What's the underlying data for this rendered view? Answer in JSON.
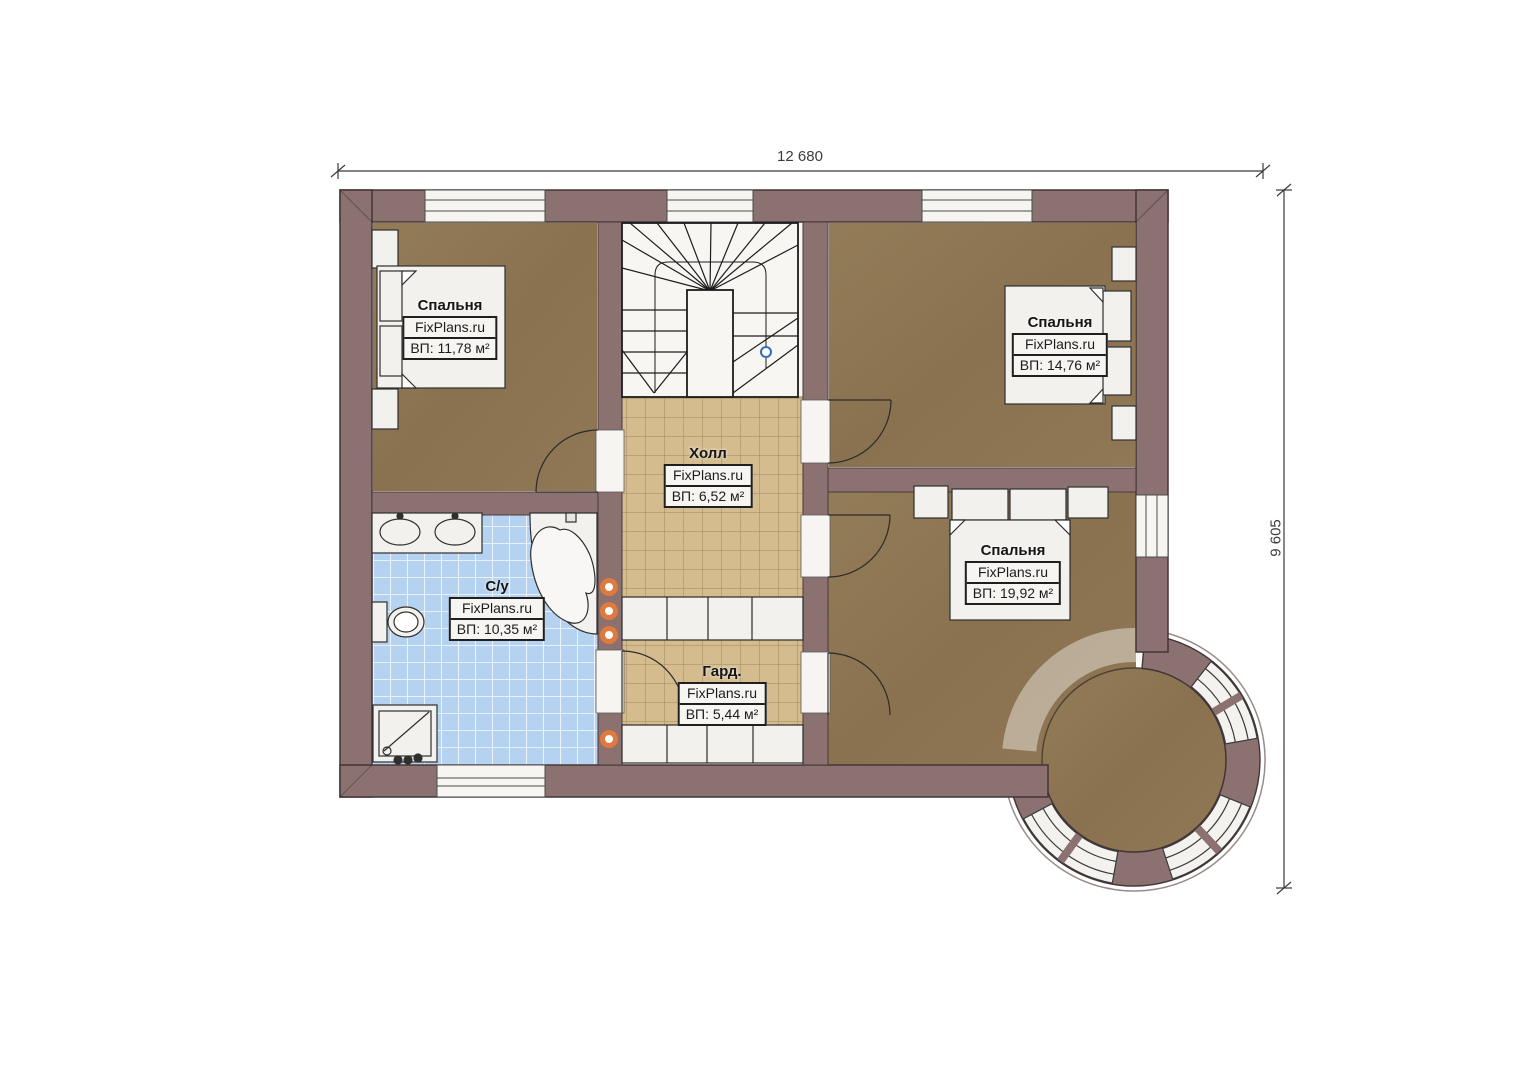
{
  "plan": {
    "dimensions": {
      "width_label": "12 680",
      "height_label": "9 605"
    },
    "rooms": [
      {
        "id": "bedroom-top-left",
        "name": "Спальня",
        "brand": "FixPlans.ru",
        "area": "ВП: 11,78 м²"
      },
      {
        "id": "bedroom-top-right",
        "name": "Спальня",
        "brand": "FixPlans.ru",
        "area": "ВП: 14,76 м²"
      },
      {
        "id": "hall",
        "name": "Холл",
        "brand": "FixPlans.ru",
        "area": "ВП: 6,52 м²"
      },
      {
        "id": "bathroom",
        "name": "С/у",
        "brand": "FixPlans.ru",
        "area": "ВП: 10,35 м²"
      },
      {
        "id": "bedroom-right",
        "name": "Спальня",
        "brand": "FixPlans.ru",
        "area": "ВП: 19,92 м²"
      },
      {
        "id": "wardrobe",
        "name": "Гард.",
        "brand": "FixPlans.ru",
        "area": "ВП: 5,44 м²"
      }
    ],
    "colors": {
      "wall": "#8c7171",
      "floor_wood": "#8d7552",
      "tile_beige": "#d4bc8e",
      "tile_blue": "#b6d2f1",
      "fixture_white": "#f4f3f0",
      "accent_orange": "#e2793c",
      "marker_blue": "#2e6db8"
    }
  }
}
